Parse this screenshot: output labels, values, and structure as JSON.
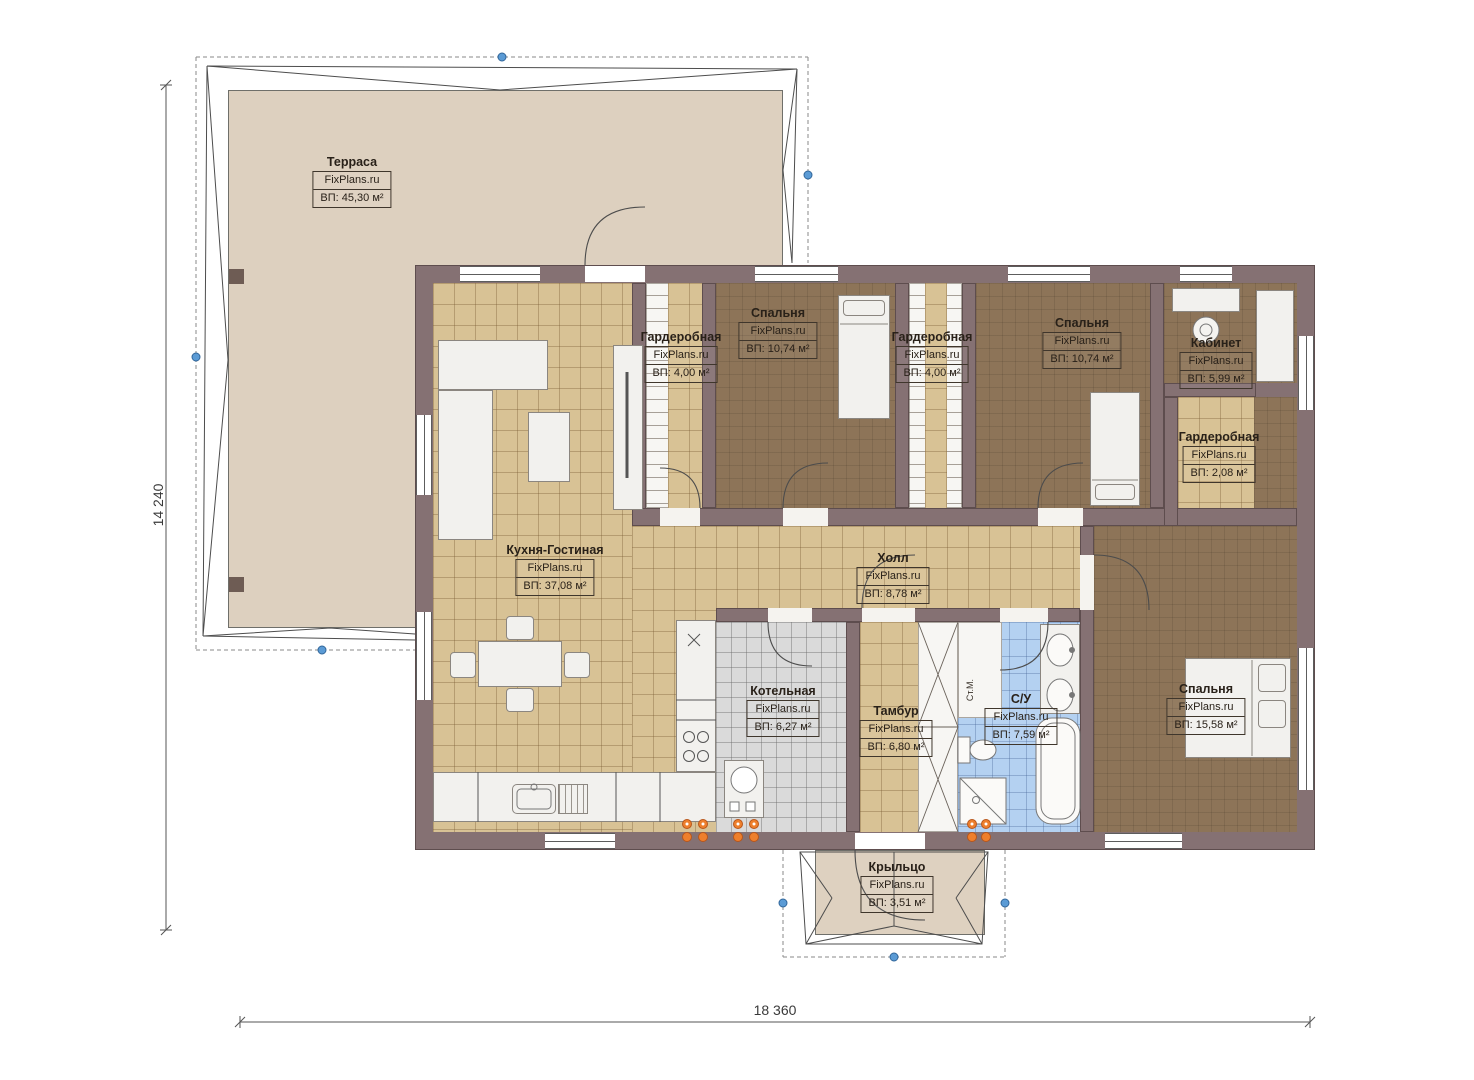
{
  "watermark": "FixPlans.ru",
  "dimensions": {
    "vertical": "14 240",
    "horizontal": "18 360"
  },
  "rooms": [
    {
      "id": "terrace",
      "name": "Терраса",
      "brand": "FixPlans.ru",
      "area": "ВП: 45,30 м²"
    },
    {
      "id": "wardrobe-1",
      "name": "Гардеробная",
      "brand": "FixPlans.ru",
      "area": "ВП: 4,00 м²"
    },
    {
      "id": "bedroom-1",
      "name": "Спальня",
      "brand": "FixPlans.ru",
      "area": "ВП: 10,74 м²"
    },
    {
      "id": "wardrobe-2",
      "name": "Гардеробная",
      "brand": "FixPlans.ru",
      "area": "ВП: 4,00 м²"
    },
    {
      "id": "bedroom-2",
      "name": "Спальня",
      "brand": "FixPlans.ru",
      "area": "ВП: 10,74 м²"
    },
    {
      "id": "office",
      "name": "Кабинет",
      "brand": "FixPlans.ru",
      "area": "ВП: 5,99 м²"
    },
    {
      "id": "wardrobe-3",
      "name": "Гардеробная",
      "brand": "FixPlans.ru",
      "area": "ВП: 2,08 м²"
    },
    {
      "id": "kitchen",
      "name": "Кухня-Гостиная",
      "brand": "FixPlans.ru",
      "area": "ВП: 37,08 м²"
    },
    {
      "id": "hall",
      "name": "Холл",
      "brand": "FixPlans.ru",
      "area": "ВП: 8,78 м²"
    },
    {
      "id": "boiler",
      "name": "Котельная",
      "brand": "FixPlans.ru",
      "area": "ВП: 6,27 м²"
    },
    {
      "id": "vestibule",
      "name": "Тамбур",
      "brand": "FixPlans.ru",
      "area": "ВП: 6,80 м²"
    },
    {
      "id": "bathroom",
      "name": "С/У",
      "brand": "FixPlans.ru",
      "area": "ВП: 7,59 м²"
    },
    {
      "id": "bedroom-3",
      "name": "Спальня",
      "brand": "FixPlans.ru",
      "area": "ВП: 15,58 м²"
    },
    {
      "id": "porch",
      "name": "Крыльцо",
      "brand": "FixPlans.ru",
      "area": "ВП: 3,51 м²"
    }
  ],
  "annotations": {
    "washing_machine": "Ст.М."
  },
  "colors": {
    "wall": "#857173",
    "kitchen_floor": "#d8c295",
    "bedroom_floor": "#8d7458",
    "bathroom_floor": "#b4d1f1",
    "boiler_floor": "#dadada",
    "terrace_floor": "#ddd0bf",
    "porch_floor": "#ded1c0",
    "marker_orange": "#ee7f2c",
    "marker_blue": "#5b9bd5"
  }
}
